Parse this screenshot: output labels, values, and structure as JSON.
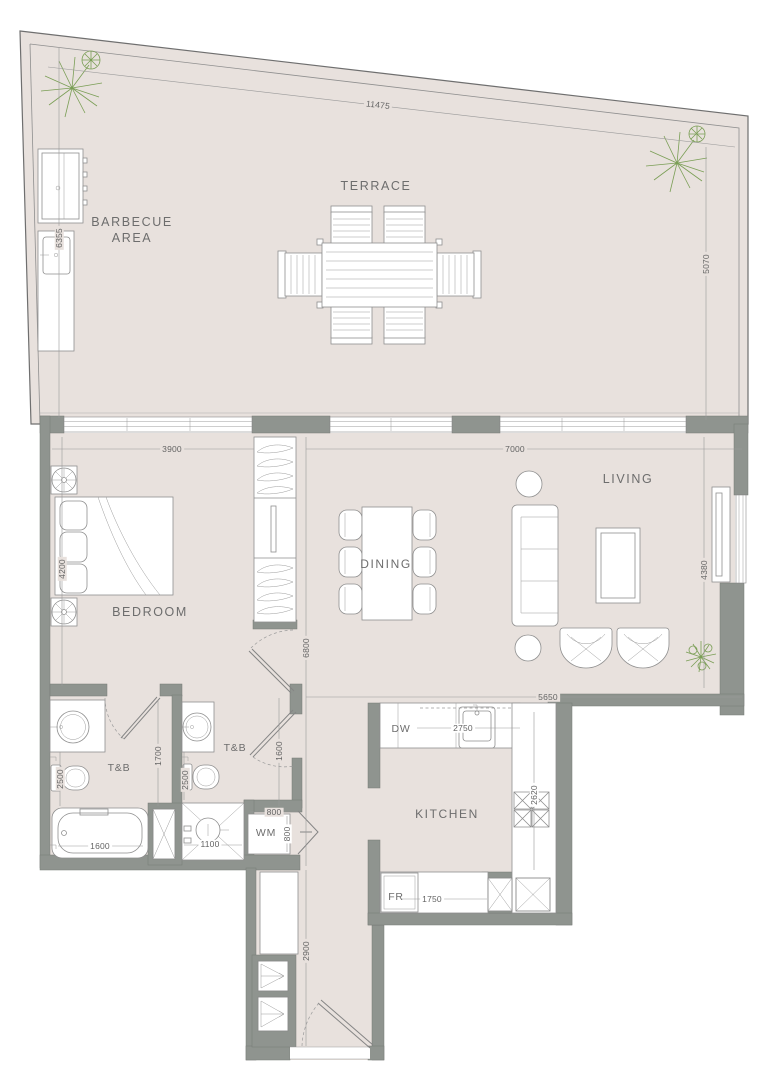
{
  "colors": {
    "floor": "#e8e1dd",
    "wall": "#8f948f",
    "plant": "#7a9e55",
    "text": "#6d6d6d",
    "dim": "#646464"
  },
  "rooms": {
    "terrace": "TERRACE",
    "barbecue_line1": "BARBECUE",
    "barbecue_line2": "AREA",
    "bedroom": "BEDROOM",
    "living": "LIVING",
    "dining": "DINING",
    "kitchen": "KITCHEN",
    "bath1": "T&B",
    "bath2": "T&B"
  },
  "appliances": {
    "dishwasher": "DW",
    "washer": "WM",
    "fridge": "FR"
  },
  "dimensions": {
    "terrace_width": "11475",
    "terrace_side_left": "6355",
    "terrace_side_right": "5070",
    "bedroom_width": "3900",
    "bedroom_depth": "4200",
    "living_width": "7000",
    "living_depth": "4380",
    "living_bottom_width": "5650",
    "hall_length": "6800",
    "entry_length": "2900",
    "kitchen_counter": "2750",
    "kitchen_depth": "2620",
    "fridge_counter": "1750",
    "bath1_width": "1700",
    "bath1_depth": "2500",
    "bathtub_length": "1600",
    "bath2_depth": "2500",
    "bath2_length": "1600",
    "shower_width": "1100",
    "washer_width": "800",
    "washer_depth": "800"
  }
}
